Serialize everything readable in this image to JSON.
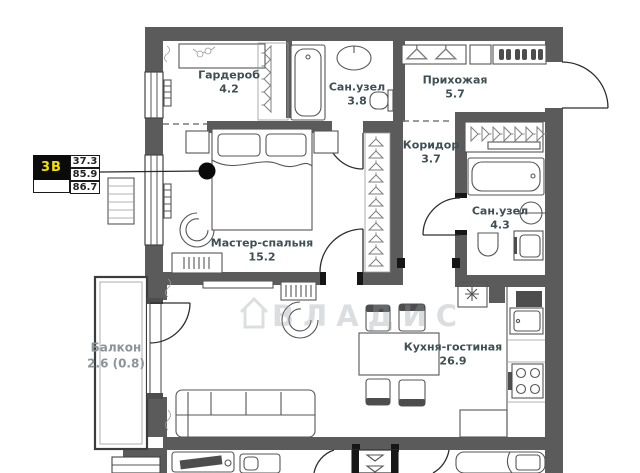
{
  "plan": {
    "legend": {
      "unit_label": "3В",
      "values": [
        "37.3",
        "85.9",
        "86.7"
      ]
    },
    "rooms": {
      "wardrobe": {
        "name": "Гардероб",
        "area": "4.2"
      },
      "bath_top": {
        "name": "Сан.узел",
        "area": "3.8"
      },
      "hallway": {
        "name": "Прихожая",
        "area": "5.7"
      },
      "corridor": {
        "name": "Коридор",
        "area": "3.7"
      },
      "bath_right": {
        "name": "Сан.узел",
        "area": "4.3"
      },
      "master": {
        "name": "Мастер-спальня",
        "area": "15.2"
      },
      "kitchen": {
        "name": "Кухня-гостиная",
        "area": "26.9"
      },
      "balcony": {
        "name": "Балкон",
        "area": "2.6 (0.8)"
      }
    },
    "watermark": "ВЛАДИС",
    "colors": {
      "wall": "#5b5b5b",
      "label": "#3e5054",
      "accent": "#f5e003",
      "muted": "#8d9499"
    }
  }
}
